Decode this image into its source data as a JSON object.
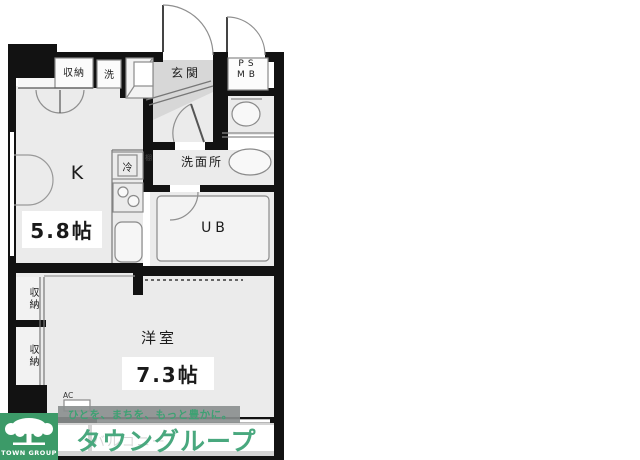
{
  "plan": {
    "labels": {
      "storage_top": "収納",
      "washer": "洗",
      "entrance": "玄関",
      "pipe_space": "PS",
      "meter_box": "MB",
      "fridge": "冷",
      "shelf": "棚",
      "washroom": "洗面所",
      "kitchen": "K",
      "kitchen_size": "5.8帖",
      "unit_bath": "UB",
      "storage_left_upper": "収納",
      "storage_left_lower": "収納",
      "western_room": "洋室",
      "western_room_size": "7.3帖",
      "air_conditioner": "AC",
      "balcony": "バルコニー"
    }
  },
  "watermark": {
    "tagline": "ひとを、まちを、もっと豊かに。",
    "brand": "タウングループ",
    "logo_caption": "TOWN GROUP",
    "brand_green": "#3c9a68",
    "text_green": "#49a87e"
  }
}
